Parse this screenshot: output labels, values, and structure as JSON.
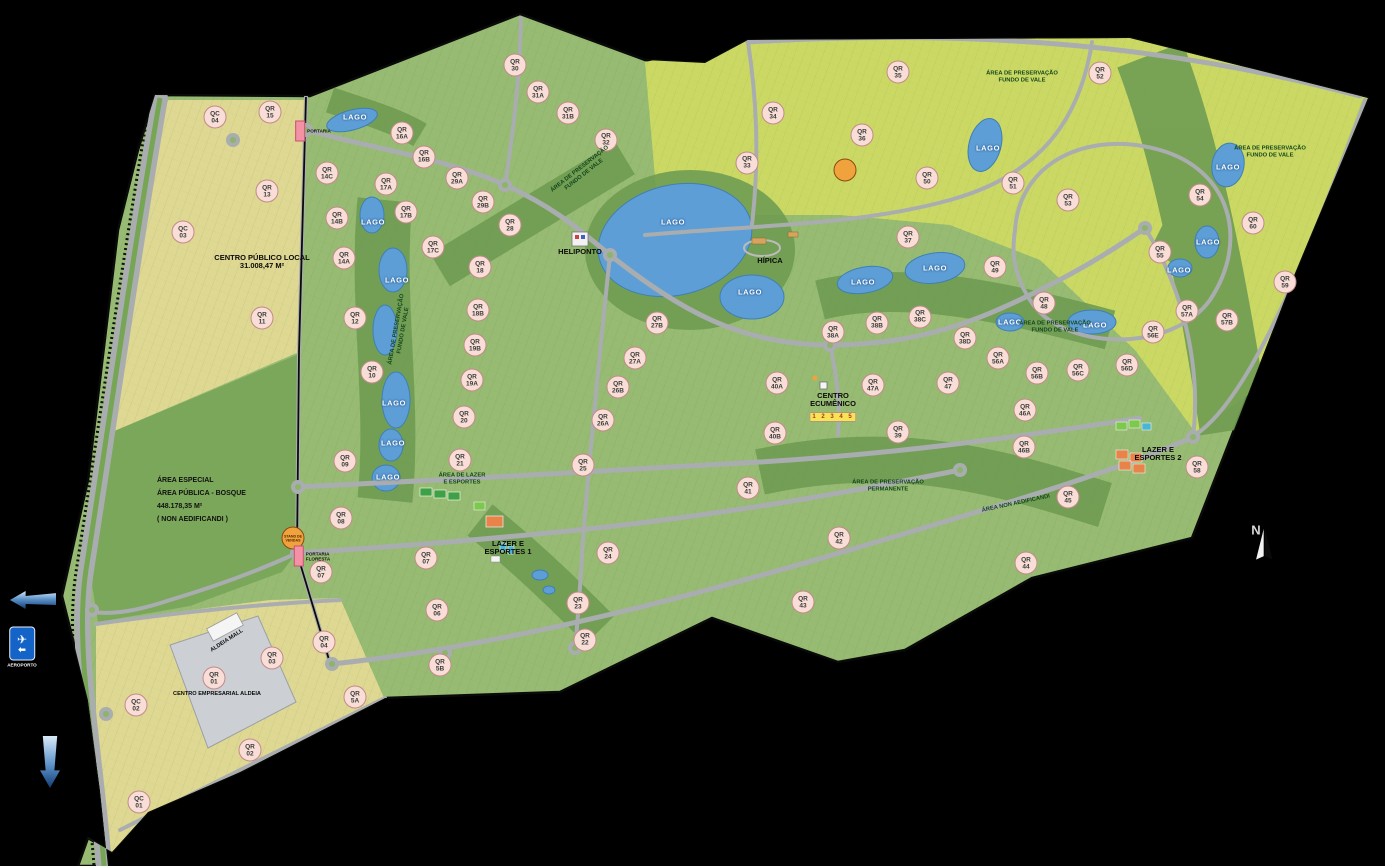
{
  "map": {
    "title": "Master plan map - Aldeia residential development",
    "colors": {
      "background": "#000000",
      "base_green": "#97bb72",
      "preservation_green": "#6f9c52",
      "bosque_green": "#7ba75a",
      "chartreuse": "#cbd964",
      "yellow_district": "#ded892",
      "lake_blue": "#5e9ed6",
      "road_gray": "#a9adb0",
      "business_gray": "#ccd0d4",
      "qr_circle": "#f8ded6",
      "poi_orange": "#f0a23c",
      "portaria_pink": "#f491a4",
      "sign_blue": "#1464c8"
    },
    "labels": [
      {
        "t": "qr",
        "text": "QC 04",
        "x": 215,
        "y": 117
      },
      {
        "t": "qr",
        "text": "QR 15",
        "x": 270,
        "y": 112
      },
      {
        "t": "qr",
        "text": "QR 16A",
        "x": 402,
        "y": 133
      },
      {
        "t": "qr",
        "text": "QR 16B",
        "x": 424,
        "y": 157
      },
      {
        "t": "qr",
        "text": "QR 14C",
        "x": 327,
        "y": 173
      },
      {
        "t": "qr",
        "text": "QR 17A",
        "x": 386,
        "y": 184
      },
      {
        "t": "qr",
        "text": "QR 13",
        "x": 267,
        "y": 191
      },
      {
        "t": "qr",
        "text": "QC 03",
        "x": 183,
        "y": 232
      },
      {
        "t": "qr",
        "text": "QR 17B",
        "x": 406,
        "y": 212
      },
      {
        "t": "qr",
        "text": "QR 14B",
        "x": 337,
        "y": 218
      },
      {
        "t": "qr",
        "text": "QR 14A",
        "x": 344,
        "y": 258
      },
      {
        "t": "qr",
        "text": "QR 12",
        "x": 355,
        "y": 318
      },
      {
        "t": "qr",
        "text": "QR 11",
        "x": 262,
        "y": 318
      },
      {
        "t": "qr",
        "text": "QR 10",
        "x": 372,
        "y": 372
      },
      {
        "t": "qr",
        "text": "QR 09",
        "x": 345,
        "y": 461
      },
      {
        "t": "qr",
        "text": "QR 08",
        "x": 341,
        "y": 518
      },
      {
        "t": "qr",
        "text": "QR 07",
        "x": 321,
        "y": 572
      },
      {
        "t": "qr",
        "text": "QR 30",
        "x": 515,
        "y": 65
      },
      {
        "t": "qr",
        "text": "QR 31A",
        "x": 538,
        "y": 92
      },
      {
        "t": "qr",
        "text": "QR 31B",
        "x": 568,
        "y": 113
      },
      {
        "t": "qr",
        "text": "QR 32",
        "x": 606,
        "y": 140
      },
      {
        "t": "qr",
        "text": "QR 29A",
        "x": 457,
        "y": 178
      },
      {
        "t": "qr",
        "text": "QR 29B",
        "x": 483,
        "y": 202
      },
      {
        "t": "qr",
        "text": "QR 28",
        "x": 510,
        "y": 225
      },
      {
        "t": "qr",
        "text": "QR 17C",
        "x": 433,
        "y": 247
      },
      {
        "t": "qr",
        "text": "QR 18",
        "x": 480,
        "y": 267
      },
      {
        "t": "qr",
        "text": "QR 18B",
        "x": 478,
        "y": 310
      },
      {
        "t": "qr",
        "text": "QR 19B",
        "x": 475,
        "y": 345
      },
      {
        "t": "qr",
        "text": "QR 19A",
        "x": 472,
        "y": 380
      },
      {
        "t": "qr",
        "text": "QR 20",
        "x": 464,
        "y": 417
      },
      {
        "t": "qr",
        "text": "QR 21",
        "x": 460,
        "y": 460
      },
      {
        "t": "qr",
        "text": "QR 25",
        "x": 583,
        "y": 465
      },
      {
        "t": "qr",
        "text": "QR 26A",
        "x": 603,
        "y": 420
      },
      {
        "t": "qr",
        "text": "QR 26B",
        "x": 618,
        "y": 387
      },
      {
        "t": "qr",
        "text": "QR 27A",
        "x": 635,
        "y": 358
      },
      {
        "t": "qr",
        "text": "QR 27B",
        "x": 657,
        "y": 323
      },
      {
        "t": "qr",
        "text": "QR 35",
        "x": 898,
        "y": 72
      },
      {
        "t": "qr",
        "text": "QR 34",
        "x": 773,
        "y": 113
      },
      {
        "t": "qr",
        "text": "QR 36",
        "x": 862,
        "y": 135
      },
      {
        "t": "qr",
        "text": "QR 33",
        "x": 747,
        "y": 163
      },
      {
        "t": "qr",
        "text": "QR 50",
        "x": 927,
        "y": 178
      },
      {
        "t": "qr",
        "text": "QR 51",
        "x": 1013,
        "y": 183
      },
      {
        "t": "qr",
        "text": "QR 37",
        "x": 908,
        "y": 237
      },
      {
        "t": "qr",
        "text": "QR 49",
        "x": 995,
        "y": 267
      },
      {
        "t": "qr",
        "text": "QR 52",
        "x": 1100,
        "y": 73
      },
      {
        "t": "qr",
        "text": "QR 53",
        "x": 1068,
        "y": 200
      },
      {
        "t": "qr",
        "text": "QR 54",
        "x": 1200,
        "y": 195
      },
      {
        "t": "qr",
        "text": "QR 60",
        "x": 1253,
        "y": 223
      },
      {
        "t": "qr",
        "text": "QR 55",
        "x": 1160,
        "y": 252
      },
      {
        "t": "qr",
        "text": "QR 59",
        "x": 1285,
        "y": 282
      },
      {
        "t": "qr",
        "text": "QR 48",
        "x": 1044,
        "y": 303
      },
      {
        "t": "qr",
        "text": "QR 57A",
        "x": 1187,
        "y": 311
      },
      {
        "t": "qr",
        "text": "QR 57B",
        "x": 1227,
        "y": 320
      },
      {
        "t": "qr",
        "text": "QR 56E",
        "x": 1153,
        "y": 332
      },
      {
        "t": "qr",
        "text": "QR 56D",
        "x": 1127,
        "y": 365
      },
      {
        "t": "qr",
        "text": "QR 56C",
        "x": 1078,
        "y": 370
      },
      {
        "t": "qr",
        "text": "QR 56B",
        "x": 1037,
        "y": 373
      },
      {
        "t": "qr",
        "text": "QR 56A",
        "x": 998,
        "y": 358
      },
      {
        "t": "qr",
        "text": "QR 38A",
        "x": 833,
        "y": 332
      },
      {
        "t": "qr",
        "text": "QR 38B",
        "x": 877,
        "y": 323
      },
      {
        "t": "qr",
        "text": "QR 38C",
        "x": 920,
        "y": 317
      },
      {
        "t": "qr",
        "text": "QR 38D",
        "x": 965,
        "y": 338
      },
      {
        "t": "qr",
        "text": "QR 40A",
        "x": 777,
        "y": 383
      },
      {
        "t": "qr",
        "text": "QR 47A",
        "x": 873,
        "y": 385
      },
      {
        "t": "qr",
        "text": "QR 47",
        "x": 948,
        "y": 383
      },
      {
        "t": "qr",
        "text": "QR 46A",
        "x": 1025,
        "y": 410
      },
      {
        "t": "qr",
        "text": "QR 40B",
        "x": 775,
        "y": 433
      },
      {
        "t": "qr",
        "text": "QR 39",
        "x": 898,
        "y": 432
      },
      {
        "t": "qr",
        "text": "QR 46B",
        "x": 1024,
        "y": 447
      },
      {
        "t": "qr",
        "text": "QR 41",
        "x": 748,
        "y": 488
      },
      {
        "t": "qr",
        "text": "QR 42",
        "x": 839,
        "y": 538
      },
      {
        "t": "qr",
        "text": "QR 43",
        "x": 803,
        "y": 602
      },
      {
        "t": "qr",
        "text": "QR 44",
        "x": 1026,
        "y": 563
      },
      {
        "t": "qr",
        "text": "QR 45",
        "x": 1068,
        "y": 497
      },
      {
        "t": "qr",
        "text": "QR 58",
        "x": 1197,
        "y": 467
      },
      {
        "t": "qr",
        "text": "QR 24",
        "x": 608,
        "y": 553
      },
      {
        "t": "qr",
        "text": "QR 23",
        "x": 578,
        "y": 603
      },
      {
        "t": "qr",
        "text": "QR 22",
        "x": 585,
        "y": 640
      },
      {
        "t": "qr",
        "text": "QR 07",
        "x": 426,
        "y": 558
      },
      {
        "t": "qr",
        "text": "QR 06",
        "x": 437,
        "y": 610
      },
      {
        "t": "qr",
        "text": "QR 5B",
        "x": 440,
        "y": 665
      },
      {
        "t": "qr",
        "text": "QR 5A",
        "x": 355,
        "y": 697
      },
      {
        "t": "qr",
        "text": "QR 04",
        "x": 324,
        "y": 642
      },
      {
        "t": "qr",
        "text": "QR 03",
        "x": 272,
        "y": 658
      },
      {
        "t": "qr",
        "text": "QR 01",
        "x": 214,
        "y": 678
      },
      {
        "t": "qr",
        "text": "QC 02",
        "x": 136,
        "y": 705
      },
      {
        "t": "qr",
        "text": "QR 02",
        "x": 250,
        "y": 750
      },
      {
        "t": "qr",
        "text": "QC 01",
        "x": 139,
        "y": 802
      },
      {
        "t": "lago",
        "text": "LAGO",
        "x": 355,
        "y": 117
      },
      {
        "t": "lago",
        "text": "LAGO",
        "x": 373,
        "y": 222
      },
      {
        "t": "lago",
        "text": "LAGO",
        "x": 397,
        "y": 280
      },
      {
        "t": "lago",
        "text": "LAGO",
        "x": 394,
        "y": 403
      },
      {
        "t": "lago",
        "text": "LAGO",
        "x": 393,
        "y": 443
      },
      {
        "t": "lago",
        "text": "LAGO",
        "x": 388,
        "y": 477
      },
      {
        "t": "lago",
        "text": "LAGO",
        "x": 673,
        "y": 222
      },
      {
        "t": "lago",
        "text": "LAGO",
        "x": 750,
        "y": 292
      },
      {
        "t": "lago",
        "text": "LAGO",
        "x": 863,
        "y": 282
      },
      {
        "t": "lago",
        "text": "LAGO",
        "x": 935,
        "y": 268
      },
      {
        "t": "lago",
        "text": "LAGO",
        "x": 988,
        "y": 148
      },
      {
        "t": "lago",
        "text": "LAGO",
        "x": 1010,
        "y": 322
      },
      {
        "t": "lago",
        "text": "LAGO",
        "x": 1095,
        "y": 325
      },
      {
        "t": "lago",
        "text": "LAGO",
        "x": 1228,
        "y": 167
      },
      {
        "t": "lago",
        "text": "LAGO",
        "x": 1208,
        "y": 242
      },
      {
        "t": "lago",
        "text": "LAGO",
        "x": 1179,
        "y": 270
      },
      {
        "t": "area",
        "text": "ÁREA DE PRESERVAÇÃO\nFUNDO DE VALE",
        "x": 582,
        "y": 172,
        "r": -38
      },
      {
        "t": "area",
        "text": "ÁREA DE PRESERVAÇÃO\nFUNDO DE VALE",
        "x": 1022,
        "y": 77
      },
      {
        "t": "area",
        "text": "ÁREA DE PRESERVAÇÃO\nFUNDO DE VALE",
        "x": 1270,
        "y": 152
      },
      {
        "t": "area",
        "text": "ÁREA DE PRESERVAÇÃO\nFUNDO DE VALE",
        "x": 1055,
        "y": 327
      },
      {
        "t": "area",
        "text": "ÁREA DE PRESERVAÇÃO\nFUNDO DE VALE",
        "x": 400,
        "y": 330,
        "r": -80
      },
      {
        "t": "area",
        "text": "ÁREA DE PRESERVAÇÃO\nPERMANENTE",
        "x": 888,
        "y": 486
      },
      {
        "t": "area",
        "text": "ÁREA NON AEDIFICANDI",
        "x": 1016,
        "y": 504,
        "r": -12
      },
      {
        "t": "area",
        "text": "ÁREA DE LAZER\nE ESPORTES",
        "x": 462,
        "y": 479
      },
      {
        "t": "place",
        "text": "HELIPONTO",
        "x": 580,
        "y": 252
      },
      {
        "t": "place",
        "text": "HÍPICA",
        "x": 770,
        "y": 261
      },
      {
        "t": "place",
        "text": "CENTRO\nECUMÊNICO",
        "x": 833,
        "y": 400
      },
      {
        "t": "place",
        "text": "LAZER E\nESPORTES 1",
        "x": 508,
        "y": 548
      },
      {
        "t": "place",
        "text": "LAZER E\nESPORTES 2",
        "x": 1158,
        "y": 454
      },
      {
        "t": "place",
        "text": "CENTRO PÚBLICO LOCAL\n31.008,47 M²",
        "x": 262,
        "y": 262
      },
      {
        "t": "place_sm",
        "text": "CENTRO EMPRESARIAL ALDEIA",
        "x": 217,
        "y": 694
      },
      {
        "t": "place_sm",
        "text": "ALDEIA MALL",
        "x": 227,
        "y": 641,
        "r": -33
      },
      {
        "t": "block",
        "text": "ÁREA ESPECIAL\nÁREA PÚBLICA - BOSQUE\n448.178,35 M²\n( NON AEDIFICANDI )",
        "x": 157,
        "y": 500
      },
      {
        "t": "strip",
        "text": "1 2 3 4 5",
        "x": 833,
        "y": 417
      },
      {
        "t": "poi",
        "text": "STAND DE\nVENDAS",
        "x": 293,
        "y": 538
      },
      {
        "t": "poi",
        "text": "",
        "x": 845,
        "y": 170
      },
      {
        "t": "portaria",
        "text": "PORTARIA",
        "x": 313,
        "y": 131
      },
      {
        "t": "portaria",
        "text": "PORTARIA\nFLORESTA",
        "x": 312,
        "y": 556
      },
      {
        "t": "sign",
        "text": "AEROPORTO",
        "x": 22,
        "y": 647
      },
      {
        "t": "arrowL",
        "text": "",
        "x": 33,
        "y": 600
      },
      {
        "t": "arrowD",
        "text": "",
        "x": 50,
        "y": 762
      },
      {
        "t": "compass",
        "text": "N",
        "x": 1256,
        "y": 530
      }
    ]
  }
}
